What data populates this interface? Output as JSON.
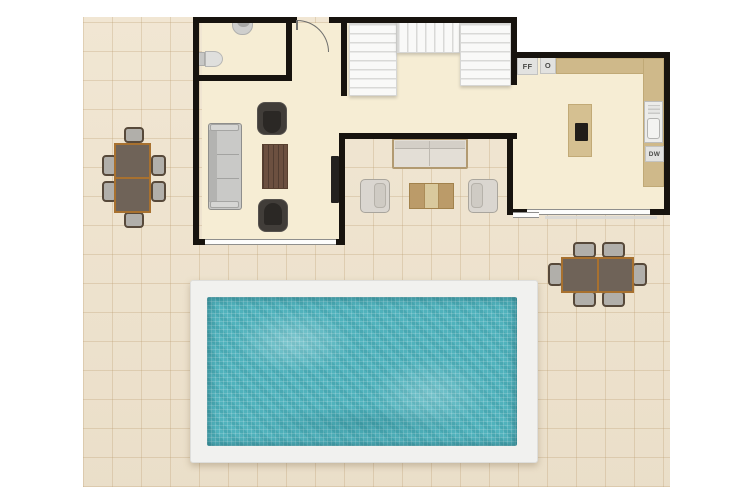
{
  "floorplan": {
    "kitchen": {
      "fridge_freezer_label": "FF",
      "oven_label": "O",
      "dishwasher_label": "DW"
    },
    "palette": {
      "wall": "#17130e",
      "interior_floor": "#f6edd4",
      "patio_tile": "#efe3cd",
      "pool_water": "#50b2bc",
      "pool_deck": "#f1f1ef",
      "counter": "#cfb98a",
      "table_wood_frame": "#a8712f",
      "dark_armchair": "#413d39",
      "stair_tread": "#f7f7f6"
    }
  }
}
